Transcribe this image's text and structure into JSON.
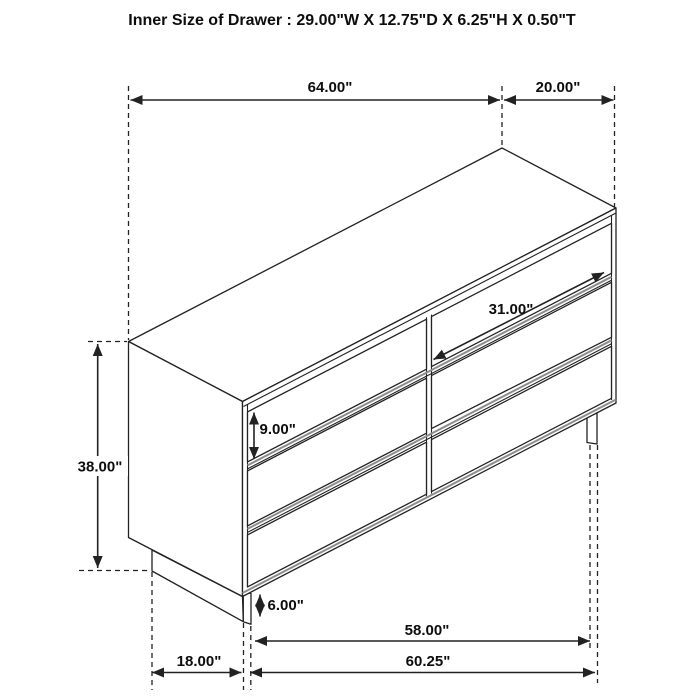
{
  "title": "Inner Size of Drawer : 29.00\"W X 12.75\"D X 6.25\"H X 0.50\"T",
  "colors": {
    "background": "#ffffff",
    "line": "#222222",
    "groove_shadow": "#8d8d8d",
    "text": "#0d0d0d"
  },
  "diagram": {
    "subject": "six-drawer dresser dimension drawing, 3/4 perspective view",
    "drawer_grid": "3 rows x 2 columns",
    "labels": {
      "top_width": "64.00\"",
      "top_depth": "20.00\"",
      "overall_height": "38.00\"",
      "drawer_height": "9.00\"",
      "drawer_width": "31.00\"",
      "base_height": "6.00\"",
      "base_width": "58.00\"",
      "floor_width": "60.25\"",
      "floor_depth": "18.00\""
    }
  }
}
